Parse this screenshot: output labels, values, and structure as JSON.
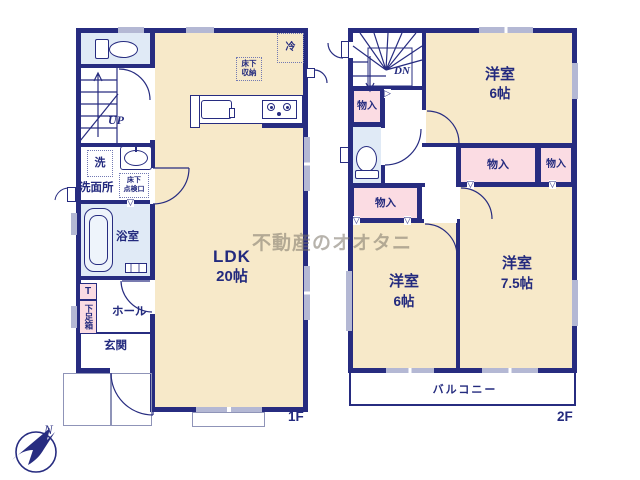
{
  "watermark": "不動産のオオタニ",
  "compass": {
    "north": "N"
  },
  "colors": {
    "wall_navy": "#272c80",
    "text_navy": "#232a7e",
    "room_tan": "#f7e9c9",
    "wet_area_blue": "#e0eaf6",
    "closet_pink": "#fbdce3",
    "window_gray": "#b4b8d4"
  },
  "floor1": {
    "label": "1F",
    "ldk": {
      "name": "LDK",
      "size": "20帖"
    },
    "fridge": "冷",
    "underfloor_storage": "床下\n収納",
    "washer": "洗",
    "washroom": "洗面所",
    "underfloor_access": "床下\n点検口",
    "bath": "浴室",
    "stairs_direction": "UP",
    "shoebox_tag": "T",
    "shoebox": "下足箱",
    "hall": "ホール",
    "entrance": "玄関"
  },
  "floor2": {
    "label": "2F",
    "stairs_direction": "DN",
    "closet": "物入",
    "bedroom_top": {
      "name": "洋室",
      "size": "6帖"
    },
    "bedroom_right": {
      "name": "洋室",
      "size": "7.5帖"
    },
    "bedroom_left": {
      "name": "洋室",
      "size": "6帖"
    },
    "balcony": "バルコニー"
  }
}
